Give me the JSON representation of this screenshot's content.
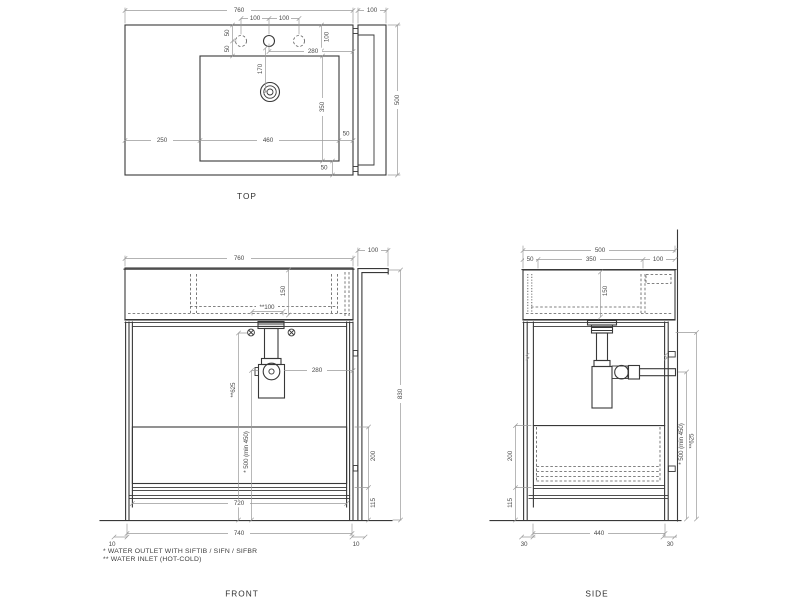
{
  "colors": {
    "background": "#ffffff",
    "object_line": "#383838",
    "dim_line": "#9b9b9b",
    "dim_text": "#4a4a4a"
  },
  "footnotes": {
    "outlet": "* WATER OUTLET WITH SIFTIB / SIFN / SIFBR",
    "inlet": "** WATER INLET (HOT-COLD)"
  },
  "views": {
    "top": {
      "label": "TOP",
      "dims": {
        "width": "760",
        "side_width": "100",
        "hole_left": "100",
        "hole_right": "100",
        "hole_edge": "50",
        "hole_basin": "50",
        "top_edge": "100",
        "faucet_to_edge": "280",
        "faucet_to_drain": "170",
        "basin_depth": "350",
        "left_margin": "250",
        "basin_width": "460",
        "right_margin": "50",
        "bottom_margin": "50",
        "depth": "500"
      }
    },
    "front": {
      "label": "FRONT",
      "dims": {
        "width": "760",
        "side_width": "100",
        "basin_height": "150",
        "inlet_spacing": "**100",
        "trap_to_side": "280",
        "inlet_height": "**625",
        "outlet_height": "* 500 (min 450)",
        "total_height": "830",
        "drawer_height": "200",
        "base_height": "115",
        "inner_width": "720",
        "base_width": "740",
        "left_inset": "10",
        "right_inset": "10"
      }
    },
    "side": {
      "label": "SIDE",
      "dims": {
        "depth": "500",
        "front_edge": "50",
        "mid_depth": "350",
        "back_gap": "100",
        "basin_height": "150",
        "drawer_height": "200",
        "base_height": "115",
        "base_depth": "440",
        "front_inset": "30",
        "back_inset": "30",
        "outlet_height": "* 500 (min 450)",
        "inlet_height": "**625"
      }
    }
  }
}
